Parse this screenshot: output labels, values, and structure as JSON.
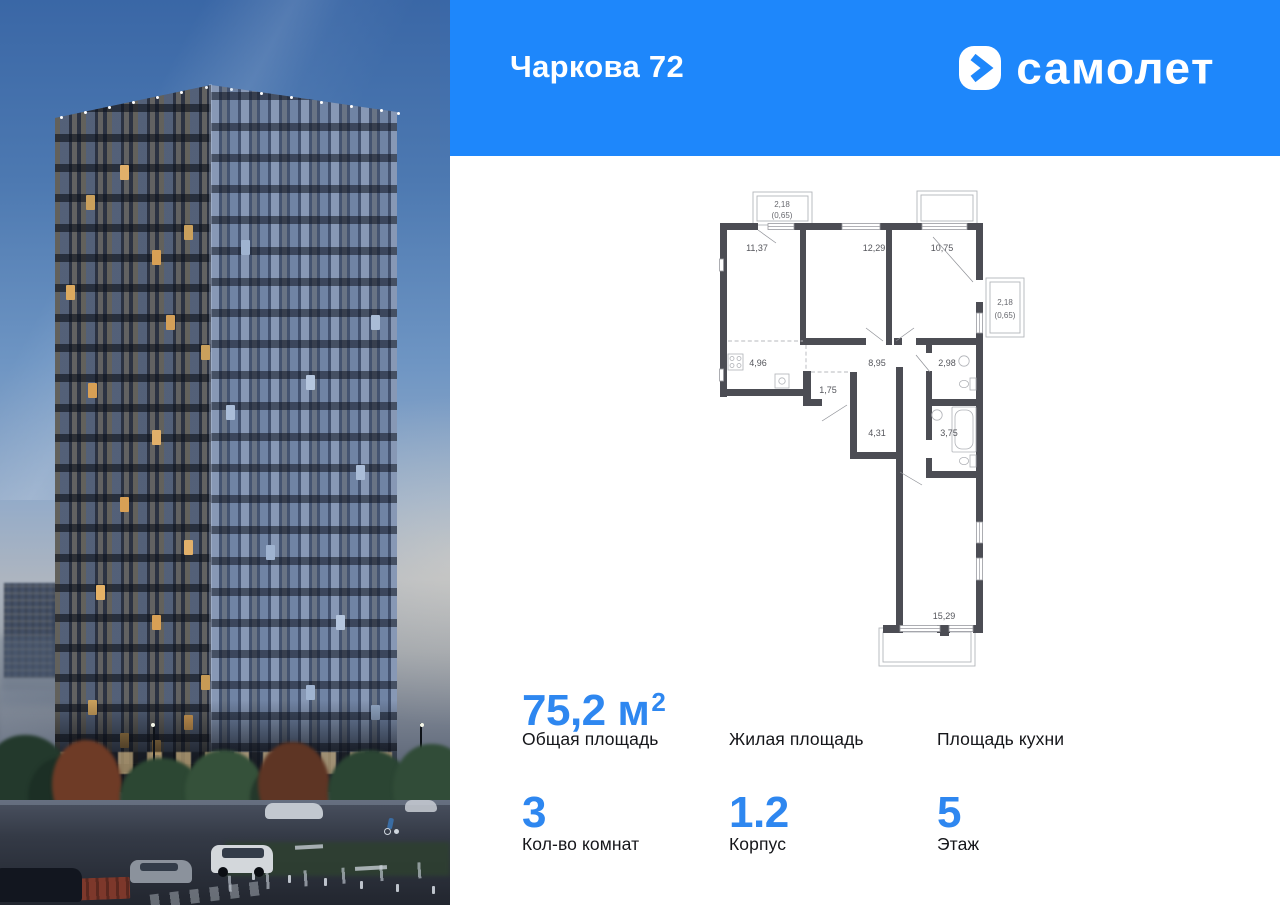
{
  "header": {
    "title": "Чаркова 72",
    "brand": "самолет"
  },
  "colors": {
    "brand_blue": "#1E87FB",
    "number_blue": "#2E87F0",
    "plan_wall": "#4C4D54"
  },
  "plan": {
    "rooms": [
      {
        "name": "bedroom-1",
        "label": "11,37"
      },
      {
        "name": "bedroom-2",
        "label": "12,29"
      },
      {
        "name": "bedroom-3",
        "label": "10,75"
      },
      {
        "name": "kitchen",
        "label": "4,96"
      },
      {
        "name": "hall",
        "label": "8,95"
      },
      {
        "name": "bathroom-small",
        "label": "2,98"
      },
      {
        "name": "corridor",
        "label": "1,75"
      },
      {
        "name": "wardrobe",
        "label": "4,31"
      },
      {
        "name": "bathroom",
        "label": "3,75"
      },
      {
        "name": "living-room",
        "label": "15,29"
      }
    ],
    "balconies": [
      {
        "name": "balcony-top",
        "area": "2,18",
        "reduced": "(0,65)"
      },
      {
        "name": "balcony-right",
        "area": "2,18",
        "reduced": "(0,65)"
      }
    ]
  },
  "stats": {
    "cells": [
      {
        "value": "75,2 м",
        "sup": "2",
        "label": "Общая площадь"
      },
      {
        "value": "",
        "sup": "",
        "label": "Жилая площадь"
      },
      {
        "value": "",
        "sup": "",
        "label": "Площадь кухни"
      },
      {
        "value": "3",
        "sup": "",
        "label": "Кол-во комнат"
      },
      {
        "value": "1.2",
        "sup": "",
        "label": "Корпус"
      },
      {
        "value": "5",
        "sup": "",
        "label": "Этаж"
      }
    ]
  }
}
